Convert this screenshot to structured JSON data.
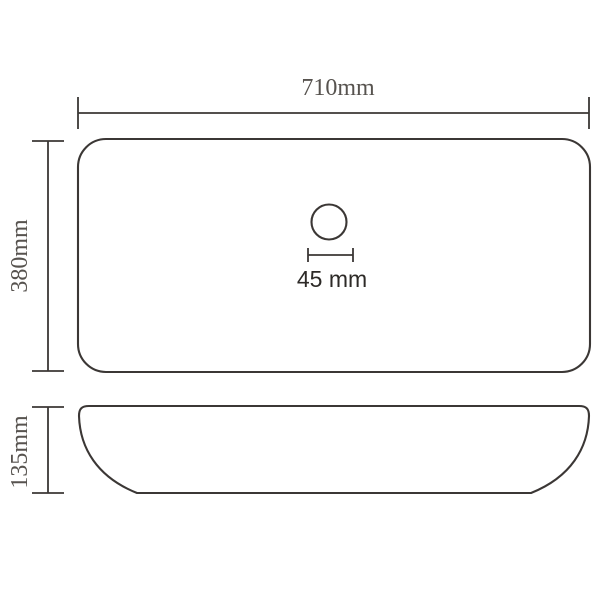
{
  "diagram": {
    "top_view": {
      "width_label": "710mm",
      "depth_label": "380mm",
      "drain_diameter_label": "45 mm"
    },
    "side_view": {
      "height_label": "135mm"
    }
  },
  "colors": {
    "background": "#ffffff",
    "line": "#3b3735",
    "dimension_text": "#57534f",
    "drain_text": "#2d2a27"
  }
}
